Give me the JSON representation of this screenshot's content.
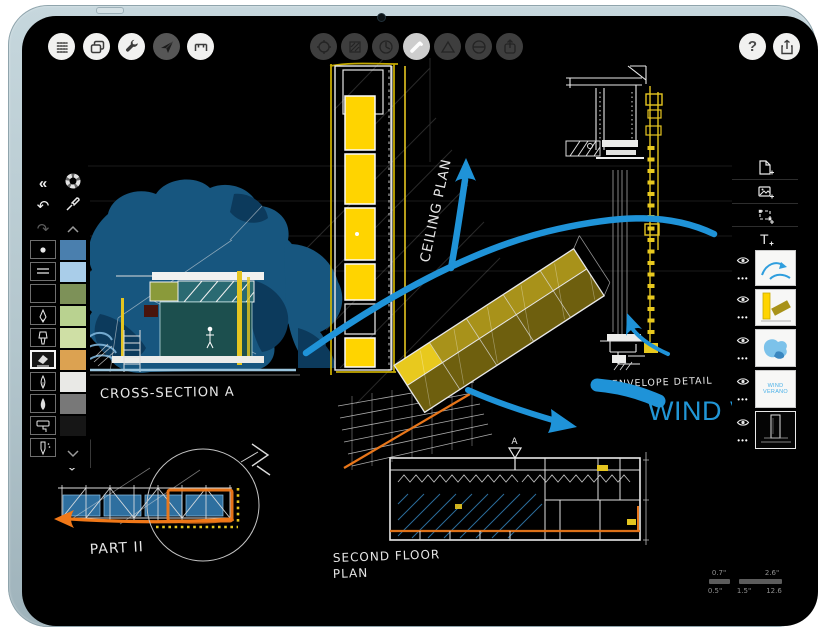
{
  "toolbar_left": {
    "buttons": [
      {
        "id": "snap-grid",
        "icon": "dot-grid-icon"
      },
      {
        "id": "pages",
        "icon": "duplicate-pages-icon"
      },
      {
        "id": "settings",
        "icon": "wrench-icon"
      },
      {
        "id": "pan-mode",
        "icon": "paper-plane-icon",
        "style": "dark"
      },
      {
        "id": "measure",
        "icon": "measure-frame-icon"
      }
    ]
  },
  "toolbar_center": {
    "buttons": [
      {
        "id": "move",
        "icon": "move-rotate-icon"
      },
      {
        "id": "fill",
        "icon": "hatch-fill-icon"
      },
      {
        "id": "guide",
        "icon": "compass-icon"
      },
      {
        "id": "pen",
        "icon": "pen-stroke-icon",
        "active": true
      },
      {
        "id": "shape",
        "icon": "triangle-ruler-icon"
      },
      {
        "id": "slice",
        "icon": "slice-circle-icon"
      },
      {
        "id": "export",
        "icon": "export-arrow-icon"
      }
    ]
  },
  "toolbar_right": {
    "help_glyph": "?",
    "share_icon": "share-up-arrow-icon"
  },
  "left_palette": {
    "collapse_glyph": "«",
    "undo_glyph": "↶",
    "redo_glyph": "↷",
    "tools": [
      {
        "id": "soft-pencil"
      },
      {
        "id": "chisel-tip"
      },
      {
        "id": "empty-slot"
      },
      {
        "id": "technical-pen"
      },
      {
        "id": "marker"
      },
      {
        "id": "eraser",
        "selected": true
      },
      {
        "id": "fountain-pen"
      },
      {
        "id": "paint-brush"
      },
      {
        "id": "paint-roller"
      },
      {
        "id": "airbrush"
      }
    ],
    "swatches": [
      {
        "color": "#4a7fae"
      },
      {
        "color": "#a9cde9"
      },
      {
        "color": "#7d9158"
      },
      {
        "color": "#b9d290"
      },
      {
        "color": "#cfdfa5"
      },
      {
        "color": "#dca251"
      },
      {
        "color": "#e9e9e6"
      },
      {
        "color": "#787878"
      },
      {
        "color": "#161616"
      }
    ]
  },
  "right_panel": {
    "more_glyph": "•••",
    "actions": [
      {
        "id": "add-page"
      },
      {
        "id": "add-image"
      },
      {
        "id": "add-selection"
      },
      {
        "id": "add-text",
        "letter": "T"
      }
    ],
    "layers": [
      {
        "id": "arrows-layer",
        "visible": true
      },
      {
        "id": "yellow-sketch-layer",
        "visible": true
      },
      {
        "id": "blue-wash-layer",
        "visible": true
      },
      {
        "id": "text-layer",
        "visible": true,
        "text": "WIND VERANO",
        "text_color": "#49b0e8"
      },
      {
        "id": "line-art-layer",
        "visible": true,
        "selected": true
      }
    ]
  },
  "canvas": {
    "labels": {
      "ceiling": "CEILING PLAN",
      "cross_section": "CROSS-SECTION A",
      "part": "PART II",
      "second_floor_1": "SECOND FLOOR",
      "second_floor_2": "PLAN",
      "envelope": "ENVELOPE DETAIL",
      "wind": "WIND VE",
      "marker_a": "A"
    },
    "colors": {
      "arrow_blue": "#1f93d8",
      "sketch_yellow": "#ffd400",
      "deep_yellow": "#a8921a",
      "accent_orange": "#f07818",
      "wash_blue": "#17567f",
      "deep_blue": "#0c3a5c",
      "teal": "#1c4f4e",
      "pale_blue": "#7fb6da",
      "text_blue": "#2196d6"
    }
  },
  "scale_indicator": {
    "minor_top": "0.7\"",
    "minor_bottom": "0.5\"",
    "major_top": "2.6\"",
    "major_bottom_left": "1.5\"",
    "major_bottom_right": "12.6"
  }
}
